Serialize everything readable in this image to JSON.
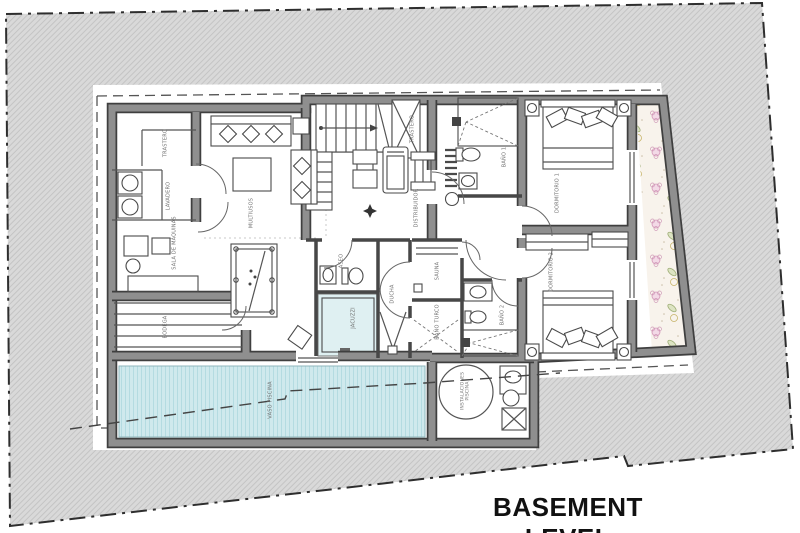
{
  "title": "BASEMENT LEVEL",
  "rooms": [
    {
      "id": "trastero-left",
      "label": "TRASTERO"
    },
    {
      "id": "lavadero",
      "label": "LAVADERO"
    },
    {
      "id": "sala-de-maquinas",
      "label": "SALA DE MÁQUINAS"
    },
    {
      "id": "bodega",
      "label": "BODEGA"
    },
    {
      "id": "multiusos",
      "label": "MULTIUSOS"
    },
    {
      "id": "trastero-escalera",
      "label": "TRASTERO"
    },
    {
      "id": "distribuidor",
      "label": "DISTRIBUIDOR"
    },
    {
      "id": "bano-1",
      "label": "BAÑO 1"
    },
    {
      "id": "dormitorio-1",
      "label": "DORMITORIO 1"
    },
    {
      "id": "aseo",
      "label": "ASEO"
    },
    {
      "id": "ducha",
      "label": "DUCHA"
    },
    {
      "id": "jacuzzi",
      "label": "JACUZZI"
    },
    {
      "id": "sauna",
      "label": "SAUNA"
    },
    {
      "id": "bano-turco",
      "label": "BAÑO TURCO"
    },
    {
      "id": "bano-2",
      "label": "BAÑO 2"
    },
    {
      "id": "dormitorio-2",
      "label": "DORMITORIO 2"
    },
    {
      "id": "vaso-piscina",
      "label": "VASO PISCINA"
    },
    {
      "id": "instalaciones-piscina",
      "label": "INSTALACIONES PISCINA"
    }
  ],
  "icons": {
    "level-marker": "✦",
    "flower": "✿"
  },
  "colors": {
    "site_hatch": "#d9d9d9",
    "hatch_line": "#c4c4c4",
    "wall_fill": "#8f8f8f",
    "wall_edge": "#3f3f3f",
    "pool_water": "#cfe9ed",
    "pool_stripe": "#b4dbe1",
    "jacuzzi_floor": "#dff0f2",
    "garden_bg": "#f8f3ec",
    "garden_pink": "#d394b6",
    "garden_green": "#9fae77",
    "boundary": "#2e2e2e",
    "label_text": "#6f6f6f",
    "title_text": "#111111"
  }
}
